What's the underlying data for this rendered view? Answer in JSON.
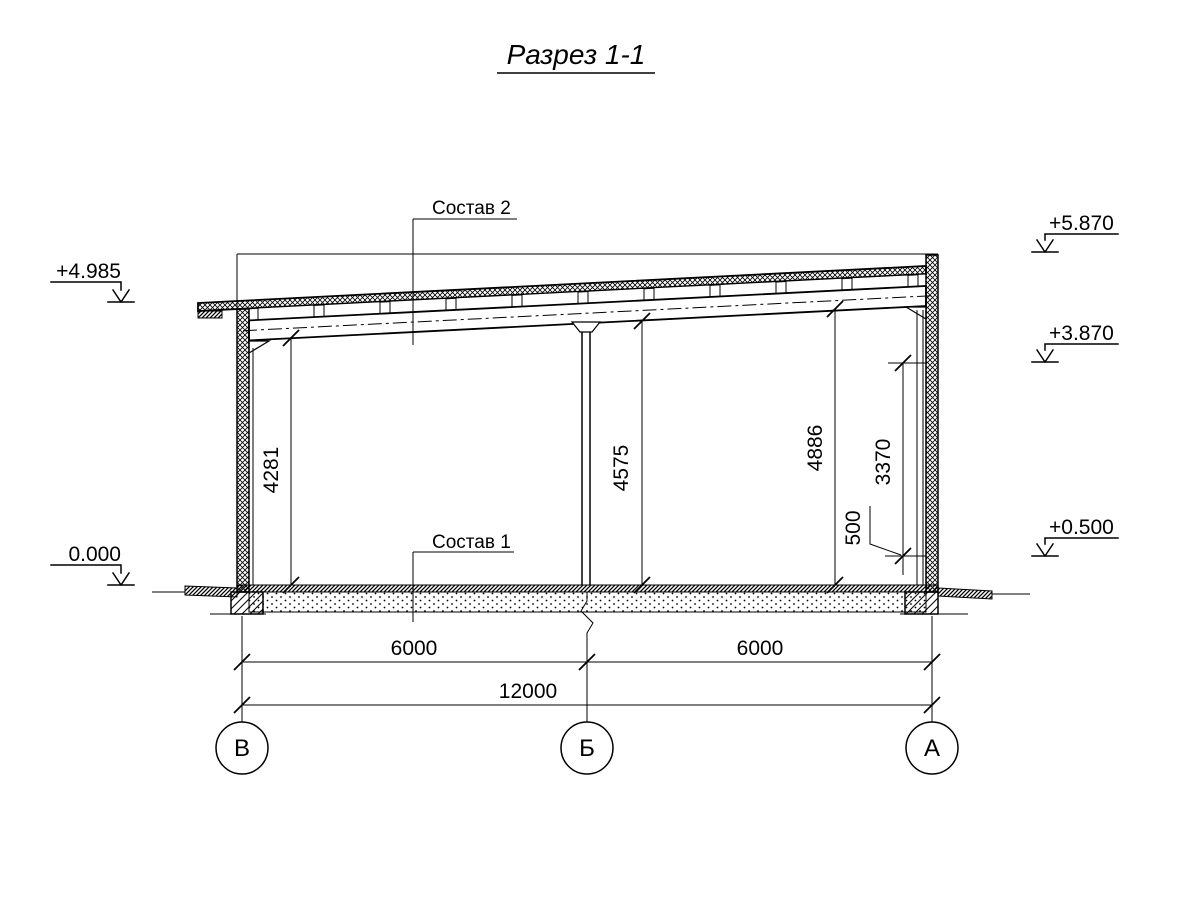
{
  "title": "Разрез 1-1",
  "callouts": {
    "roof": "Состав 2",
    "floor": "Состав 1"
  },
  "elevations": {
    "left_roof": "+4.985",
    "ground": "0.000",
    "right_top": "+5.870",
    "right_beam": "+3.870",
    "right_plinth": "+0.500"
  },
  "dims_vertical": {
    "left_clear": "4281",
    "mid_clear": "4575",
    "right_clear": "4886",
    "wall_inner": "3370",
    "plinth": "500"
  },
  "dims_horizontal": {
    "bay1": "6000",
    "bay2": "6000",
    "total": "12000"
  },
  "axes": {
    "left": "В",
    "middle": "Б",
    "right": "А"
  }
}
